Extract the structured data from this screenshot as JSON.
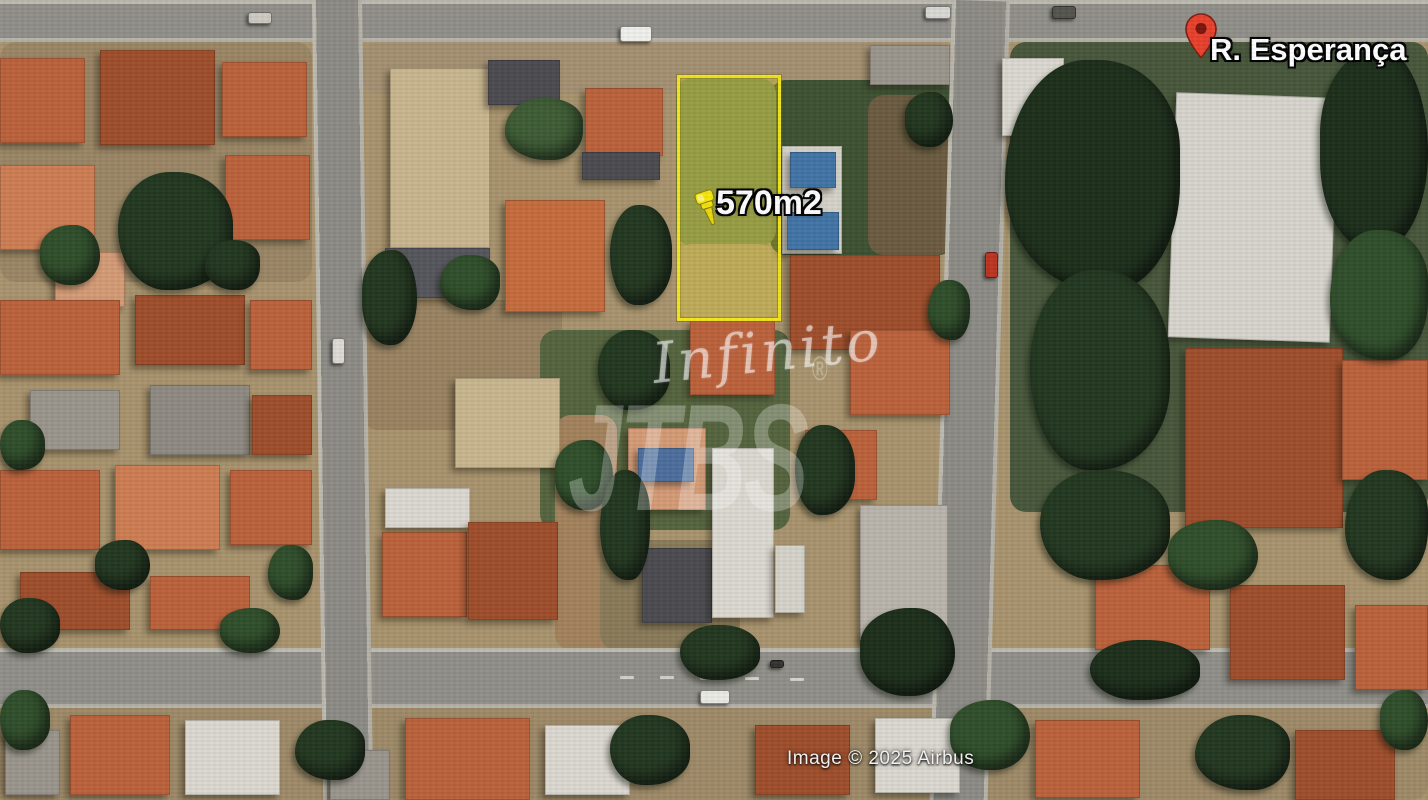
{
  "meta": {
    "kind": "satellite-aerial-photo",
    "width": 1428,
    "height": 800
  },
  "overlays": {
    "street_label": "R. Esperança",
    "area_label": "570m2",
    "watermark_script": "Infinito",
    "watermark_brand": "JTBS",
    "watermark_reg": "®",
    "attribution": "Image © 2025 Airbus"
  },
  "colors": {
    "lot_border_yellow": "#f2e51c",
    "pin_red": "#e8402d",
    "pushpin_yellow": "#f2e20c",
    "label_white": "#ffffff",
    "road_gray": "#8f8e88"
  },
  "lot": {
    "x": 677,
    "y": 75,
    "w": 98,
    "h": 240
  },
  "scene": {
    "patches": [
      {
        "x": 0,
        "y": 42,
        "w": 312,
        "h": 240,
        "c": "#9b8663"
      },
      {
        "x": 362,
        "y": 42,
        "w": 590,
        "h": 52,
        "c": "#a59070"
      },
      {
        "x": 362,
        "y": 300,
        "w": 200,
        "h": 130,
        "c": "#99825f"
      },
      {
        "x": 1010,
        "y": 42,
        "w": 418,
        "h": 470,
        "c": "#46573a"
      },
      {
        "x": 770,
        "y": 80,
        "w": 185,
        "h": 175,
        "c": "#3d5131"
      },
      {
        "x": 868,
        "y": 95,
        "w": 84,
        "h": 160,
        "c": "#6b5b3e"
      },
      {
        "x": 676,
        "y": 78,
        "w": 100,
        "h": 168,
        "c": "#77864e"
      },
      {
        "x": 676,
        "y": 244,
        "w": 100,
        "h": 74,
        "c": "#b29a6d"
      },
      {
        "x": 540,
        "y": 330,
        "w": 250,
        "h": 200,
        "c": "#55643c"
      },
      {
        "x": 555,
        "y": 415,
        "w": 62,
        "h": 235,
        "c": "#a4825a"
      },
      {
        "x": 600,
        "y": 540,
        "w": 140,
        "h": 110,
        "c": "#8a7a57"
      },
      {
        "x": 0,
        "y": 708,
        "w": 1428,
        "h": 92,
        "c": "#9f8a66"
      }
    ],
    "roads": [
      {
        "x": 0,
        "y": 0,
        "w": 1428,
        "h": 42,
        "dir": "h"
      },
      {
        "x": 0,
        "y": 648,
        "w": 1428,
        "h": 60,
        "dir": "h"
      },
      {
        "x": 312,
        "y": 0,
        "w": 50,
        "h": 800,
        "dir": "v",
        "rot": -0.8
      },
      {
        "x": 952,
        "y": 0,
        "w": 58,
        "h": 800,
        "dir": "v",
        "rot": 1.6
      }
    ],
    "road_dashes": [
      {
        "x": 620,
        "y": 676,
        "w": 14,
        "h": 3
      },
      {
        "x": 660,
        "y": 676,
        "w": 14,
        "h": 3
      },
      {
        "x": 700,
        "y": 677,
        "w": 14,
        "h": 3
      },
      {
        "x": 745,
        "y": 677,
        "w": 14,
        "h": 3
      },
      {
        "x": 790,
        "y": 678,
        "w": 14,
        "h": 3
      },
      {
        "x": 878,
        "y": 660,
        "w": 4,
        "h": 14
      },
      {
        "x": 890,
        "y": 660,
        "w": 4,
        "h": 14
      }
    ],
    "buildings": [
      {
        "x": 0,
        "y": 58,
        "w": 85,
        "h": 85,
        "c": "#bf6038",
        "t": "ridge"
      },
      {
        "x": 100,
        "y": 50,
        "w": 115,
        "h": 95,
        "c": "#a14c28",
        "t": "ridge"
      },
      {
        "x": 222,
        "y": 62,
        "w": 85,
        "h": 75,
        "c": "#bf6038",
        "t": "ridge"
      },
      {
        "x": 0,
        "y": 165,
        "w": 95,
        "h": 85,
        "c": "#d07c50",
        "t": "ridge"
      },
      {
        "x": 225,
        "y": 155,
        "w": 85,
        "h": 85,
        "c": "#bf6038",
        "t": "ridge"
      },
      {
        "x": 55,
        "y": 252,
        "w": 70,
        "h": 55,
        "c": "#d69a74",
        "t": "ridge"
      },
      {
        "x": 0,
        "y": 300,
        "w": 120,
        "h": 75,
        "c": "#bf6038",
        "t": "ridge"
      },
      {
        "x": 135,
        "y": 295,
        "w": 110,
        "h": 70,
        "c": "#a14c28",
        "t": "ridge"
      },
      {
        "x": 250,
        "y": 300,
        "w": 62,
        "h": 70,
        "c": "#bf6038",
        "t": "ridge"
      },
      {
        "x": 30,
        "y": 390,
        "w": 90,
        "h": 60,
        "c": "#9a958c",
        "t": "flat"
      },
      {
        "x": 150,
        "y": 385,
        "w": 100,
        "h": 70,
        "c": "#8e8a82",
        "t": "flat"
      },
      {
        "x": 252,
        "y": 395,
        "w": 60,
        "h": 60,
        "c": "#a14c28",
        "t": "ridge"
      },
      {
        "x": 0,
        "y": 470,
        "w": 100,
        "h": 80,
        "c": "#bf6038",
        "t": "ridge"
      },
      {
        "x": 115,
        "y": 465,
        "w": 105,
        "h": 85,
        "c": "#d07c50",
        "t": "ridge"
      },
      {
        "x": 230,
        "y": 470,
        "w": 82,
        "h": 75,
        "c": "#bf6038",
        "t": "ridge"
      },
      {
        "x": 20,
        "y": 572,
        "w": 110,
        "h": 58,
        "c": "#a14c28",
        "t": "ridge"
      },
      {
        "x": 150,
        "y": 576,
        "w": 100,
        "h": 54,
        "c": "#bf6038",
        "t": "ridge"
      },
      {
        "x": 390,
        "y": 68,
        "w": 100,
        "h": 180,
        "c": "#c9b68d",
        "t": "mottle"
      },
      {
        "x": 385,
        "y": 248,
        "w": 105,
        "h": 50,
        "c": "#55555c",
        "t": "flat"
      },
      {
        "x": 488,
        "y": 60,
        "w": 72,
        "h": 45,
        "c": "#4a4a50",
        "t": "flat"
      },
      {
        "x": 585,
        "y": 88,
        "w": 78,
        "h": 68,
        "c": "#bf6038",
        "t": "ridge"
      },
      {
        "x": 582,
        "y": 152,
        "w": 78,
        "h": 28,
        "c": "#4a4a50",
        "t": "flat"
      },
      {
        "x": 505,
        "y": 200,
        "w": 100,
        "h": 112,
        "c": "#c96a3a",
        "t": "ridge"
      },
      {
        "x": 1002,
        "y": 58,
        "w": 62,
        "h": 78,
        "c": "#dbd8d0",
        "t": "hstripes"
      },
      {
        "x": 782,
        "y": 146,
        "w": 60,
        "h": 108,
        "c": "#d5d3c8",
        "t": "flat"
      },
      {
        "x": 790,
        "y": 152,
        "w": 46,
        "h": 36,
        "c": "#3f74a8",
        "t": "flat"
      },
      {
        "x": 787,
        "y": 212,
        "w": 52,
        "h": 38,
        "c": "#3f74a8",
        "t": "flat"
      },
      {
        "x": 690,
        "y": 320,
        "w": 85,
        "h": 75,
        "c": "#bf6038",
        "t": "ridge"
      },
      {
        "x": 790,
        "y": 255,
        "w": 150,
        "h": 95,
        "c": "#a14c28",
        "t": "ridge"
      },
      {
        "x": 850,
        "y": 330,
        "w": 100,
        "h": 85,
        "c": "#bf6038",
        "t": "ridge"
      },
      {
        "x": 455,
        "y": 378,
        "w": 105,
        "h": 90,
        "c": "#c9b68d",
        "t": "mottle"
      },
      {
        "x": 385,
        "y": 488,
        "w": 85,
        "h": 40,
        "c": "#dbd8d0",
        "t": "flat"
      },
      {
        "x": 382,
        "y": 532,
        "w": 85,
        "h": 85,
        "c": "#bf6038",
        "t": "ridge"
      },
      {
        "x": 468,
        "y": 522,
        "w": 90,
        "h": 98,
        "c": "#a14c28",
        "t": "ridge"
      },
      {
        "x": 628,
        "y": 428,
        "w": 78,
        "h": 82,
        "c": "#d69a74",
        "t": "ridge"
      },
      {
        "x": 638,
        "y": 448,
        "w": 56,
        "h": 34,
        "c": "#4a6ea0",
        "t": "flat"
      },
      {
        "x": 642,
        "y": 548,
        "w": 70,
        "h": 75,
        "c": "#4a4a50",
        "t": "ridge"
      },
      {
        "x": 712,
        "y": 448,
        "w": 62,
        "h": 170,
        "c": "#dbd8d0",
        "t": "hstripes"
      },
      {
        "x": 775,
        "y": 545,
        "w": 30,
        "h": 68,
        "c": "#d5d3c8",
        "t": "flat"
      },
      {
        "x": 805,
        "y": 430,
        "w": 72,
        "h": 70,
        "c": "#bf6038",
        "t": "ridge"
      },
      {
        "x": 860,
        "y": 505,
        "w": 88,
        "h": 135,
        "c": "#b9b4aa",
        "t": "hstripes"
      },
      {
        "x": 870,
        "y": 45,
        "w": 80,
        "h": 40,
        "c": "#9a958c",
        "t": "flat"
      },
      {
        "x": 1172,
        "y": 95,
        "w": 162,
        "h": 245,
        "c": "#d6d4cc",
        "t": "hstripes",
        "rot": 2
      },
      {
        "x": 1050,
        "y": 80,
        "w": 60,
        "h": 55,
        "c": "#bf6038",
        "t": "ridge"
      },
      {
        "x": 1185,
        "y": 348,
        "w": 158,
        "h": 180,
        "c": "#a14c28",
        "t": "vstripes"
      },
      {
        "x": 1342,
        "y": 360,
        "w": 86,
        "h": 120,
        "c": "#bf6038",
        "t": "ridge"
      },
      {
        "x": 1095,
        "y": 565,
        "w": 115,
        "h": 85,
        "c": "#bf6038",
        "t": "ridge"
      },
      {
        "x": 1230,
        "y": 585,
        "w": 115,
        "h": 95,
        "c": "#a14c28",
        "t": "ridge"
      },
      {
        "x": 1355,
        "y": 605,
        "w": 73,
        "h": 85,
        "c": "#bf6038",
        "t": "ridge"
      },
      {
        "x": 70,
        "y": 715,
        "w": 100,
        "h": 80,
        "c": "#bf6038",
        "t": "ridge"
      },
      {
        "x": 185,
        "y": 720,
        "w": 95,
        "h": 75,
        "c": "#dbd8d0",
        "t": "flat"
      },
      {
        "x": 5,
        "y": 730,
        "w": 55,
        "h": 65,
        "c": "#9a958c",
        "t": "flat"
      },
      {
        "x": 330,
        "y": 750,
        "w": 60,
        "h": 50,
        "c": "#9a958c",
        "t": "flat"
      },
      {
        "x": 405,
        "y": 718,
        "w": 125,
        "h": 82,
        "c": "#bf6038",
        "t": "ridge"
      },
      {
        "x": 545,
        "y": 725,
        "w": 85,
        "h": 70,
        "c": "#dbd8d0",
        "t": "flat"
      },
      {
        "x": 755,
        "y": 725,
        "w": 95,
        "h": 70,
        "c": "#a14c28",
        "t": "ridge"
      },
      {
        "x": 875,
        "y": 718,
        "w": 85,
        "h": 75,
        "c": "#dbd8d0",
        "t": "flat"
      },
      {
        "x": 1035,
        "y": 720,
        "w": 105,
        "h": 78,
        "c": "#bf6038",
        "t": "ridge"
      },
      {
        "x": 1295,
        "y": 730,
        "w": 100,
        "h": 70,
        "c": "#a14c28",
        "t": "ridge"
      }
    ],
    "trees": [
      {
        "x": 118,
        "y": 172,
        "w": 115,
        "h": 118,
        "c": "#22381f"
      },
      {
        "x": 40,
        "y": 225,
        "w": 60,
        "h": 60,
        "c": "#2f4f2a"
      },
      {
        "x": 205,
        "y": 240,
        "w": 55,
        "h": 50,
        "c": "#22381f"
      },
      {
        "x": 0,
        "y": 420,
        "w": 45,
        "h": 50,
        "c": "#2f4f2a"
      },
      {
        "x": 95,
        "y": 540,
        "w": 55,
        "h": 50,
        "c": "#22381f"
      },
      {
        "x": 268,
        "y": 545,
        "w": 45,
        "h": 55,
        "c": "#2f4f2a"
      },
      {
        "x": 0,
        "y": 598,
        "w": 60,
        "h": 55,
        "c": "#22381f"
      },
      {
        "x": 220,
        "y": 608,
        "w": 60,
        "h": 45,
        "c": "#2f4f2a"
      },
      {
        "x": 505,
        "y": 98,
        "w": 78,
        "h": 62,
        "c": "#3c5c33"
      },
      {
        "x": 610,
        "y": 205,
        "w": 62,
        "h": 100,
        "c": "#22381f"
      },
      {
        "x": 362,
        "y": 250,
        "w": 55,
        "h": 95,
        "c": "#22381f"
      },
      {
        "x": 440,
        "y": 255,
        "w": 60,
        "h": 55,
        "c": "#2f4f2a"
      },
      {
        "x": 598,
        "y": 330,
        "w": 72,
        "h": 80,
        "c": "#22381f"
      },
      {
        "x": 555,
        "y": 440,
        "w": 58,
        "h": 70,
        "c": "#2f4f2a"
      },
      {
        "x": 600,
        "y": 470,
        "w": 50,
        "h": 110,
        "c": "#22381f"
      },
      {
        "x": 795,
        "y": 425,
        "w": 60,
        "h": 90,
        "c": "#22381f"
      },
      {
        "x": 905,
        "y": 92,
        "w": 48,
        "h": 55,
        "c": "#22381f"
      },
      {
        "x": 928,
        "y": 280,
        "w": 42,
        "h": 60,
        "c": "#2f4f2a"
      },
      {
        "x": 680,
        "y": 625,
        "w": 80,
        "h": 55,
        "c": "#22381f"
      },
      {
        "x": 860,
        "y": 608,
        "w": 95,
        "h": 88,
        "c": "#1c2f1a"
      },
      {
        "x": 1005,
        "y": 60,
        "w": 175,
        "h": 230,
        "c": "#1c2f1a"
      },
      {
        "x": 1030,
        "y": 270,
        "w": 140,
        "h": 200,
        "c": "#22381f"
      },
      {
        "x": 1320,
        "y": 50,
        "w": 108,
        "h": 200,
        "c": "#1c2f1a"
      },
      {
        "x": 1330,
        "y": 230,
        "w": 98,
        "h": 130,
        "c": "#2f4f2a"
      },
      {
        "x": 1040,
        "y": 470,
        "w": 130,
        "h": 110,
        "c": "#22381f"
      },
      {
        "x": 1168,
        "y": 520,
        "w": 90,
        "h": 70,
        "c": "#2f4f2a"
      },
      {
        "x": 1345,
        "y": 470,
        "w": 83,
        "h": 110,
        "c": "#22381f"
      },
      {
        "x": 1090,
        "y": 640,
        "w": 110,
        "h": 60,
        "c": "#1c2f1a"
      },
      {
        "x": 1380,
        "y": 690,
        "w": 48,
        "h": 60,
        "c": "#2f4f2a"
      },
      {
        "x": 295,
        "y": 720,
        "w": 70,
        "h": 60,
        "c": "#22381f"
      },
      {
        "x": 610,
        "y": 715,
        "w": 80,
        "h": 70,
        "c": "#22381f"
      },
      {
        "x": 950,
        "y": 700,
        "w": 80,
        "h": 70,
        "c": "#2f4f2a"
      },
      {
        "x": 1195,
        "y": 715,
        "w": 95,
        "h": 75,
        "c": "#22381f"
      },
      {
        "x": 0,
        "y": 690,
        "w": 50,
        "h": 60,
        "c": "#2f4f2a"
      }
    ],
    "cars": [
      {
        "x": 620,
        "y": 26,
        "w": 32,
        "h": 16,
        "c": "#f0f0ec"
      },
      {
        "x": 925,
        "y": 6,
        "w": 26,
        "h": 13,
        "c": "#d8d8d4"
      },
      {
        "x": 1052,
        "y": 6,
        "w": 24,
        "h": 13,
        "c": "#55544e"
      },
      {
        "x": 248,
        "y": 12,
        "w": 24,
        "h": 12,
        "c": "#cccac2"
      },
      {
        "x": 985,
        "y": 252,
        "w": 13,
        "h": 26,
        "c": "#c23320"
      },
      {
        "x": 700,
        "y": 690,
        "w": 30,
        "h": 14,
        "c": "#ebebe6"
      },
      {
        "x": 332,
        "y": 338,
        "w": 13,
        "h": 26,
        "c": "#dddbd4"
      },
      {
        "x": 770,
        "y": 660,
        "w": 14,
        "h": 8,
        "c": "#333330"
      }
    ]
  }
}
